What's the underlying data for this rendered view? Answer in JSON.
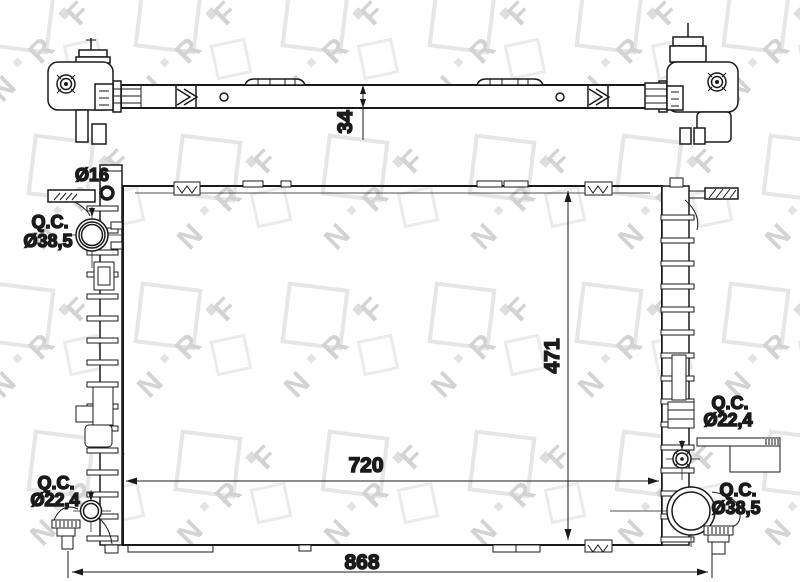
{
  "title": "Radiator technical drawing",
  "watermark": {
    "brand": "NRF",
    "letters": "N R F"
  },
  "colors": {
    "line": "#1a1a1a",
    "background": "#ffffff",
    "watermark": "#d3d3d3"
  },
  "top_view": {
    "thickness": "34"
  },
  "front_view": {
    "height": "471",
    "core_width": "720",
    "overall_width": "868",
    "ports": {
      "top_left": {
        "dia": "Ø16"
      },
      "left_upper": {
        "abbr": "Q.C.",
        "dia": "Ø38,5"
      },
      "left_lower": {
        "abbr": "Q.C.",
        "dia": "Ø22,4"
      },
      "right_upper": {
        "abbr": "Q.C.",
        "dia": "Ø22,4"
      },
      "right_lower": {
        "abbr": "Q.C.",
        "dia": "Ø38,5"
      }
    }
  }
}
